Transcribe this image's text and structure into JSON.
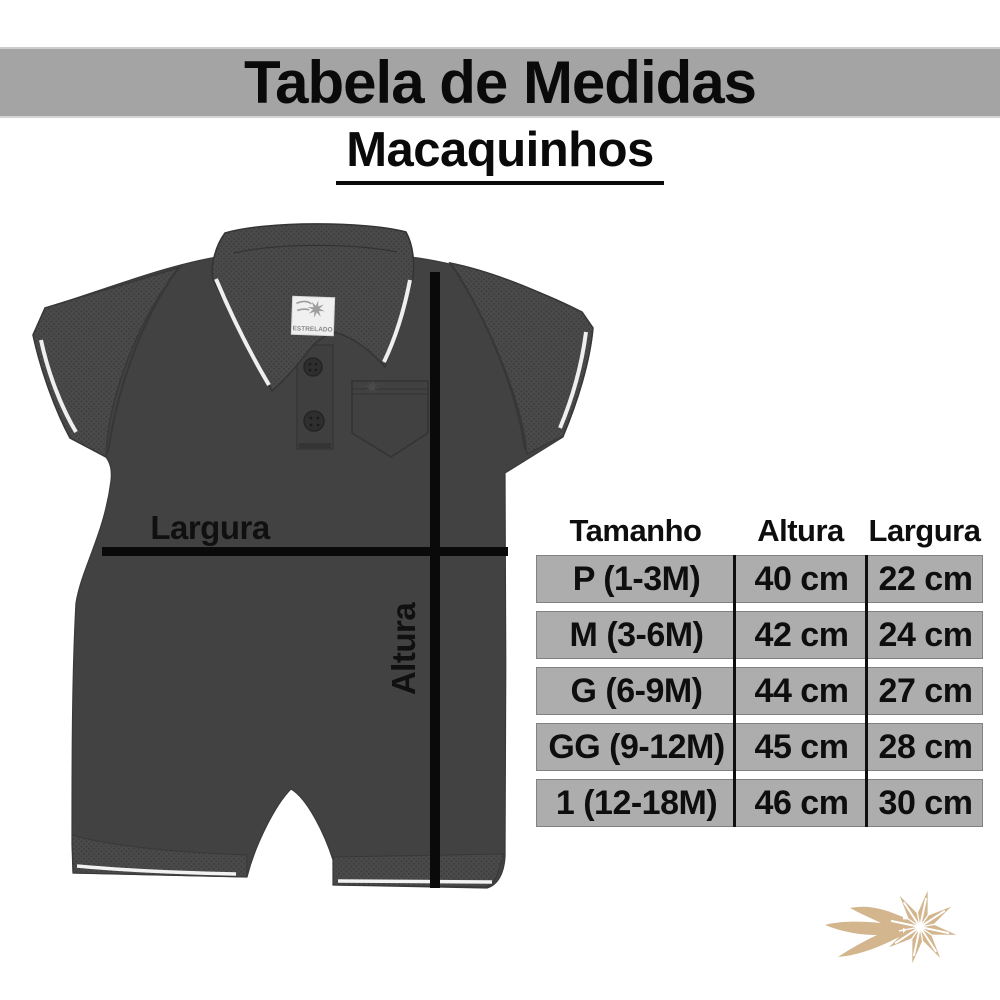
{
  "header": {
    "title": "Tabela de Medidas",
    "subtitle": "Macaquinhos",
    "band_color": "#a4a4a4"
  },
  "diagram": {
    "width_label": "Largura",
    "height_label": "Altura",
    "tag_brand": "ESTRELADO",
    "garment_color": "#424242",
    "line_color": "#0a0a0a"
  },
  "size_table": {
    "headers": [
      "Tamanho",
      "Altura",
      "Largura"
    ],
    "rows": [
      [
        "P (1-3M)",
        "40 cm",
        "22 cm"
      ],
      [
        "M (3-6M)",
        "42 cm",
        "24 cm"
      ],
      [
        "G (6-9M)",
        "44 cm",
        "27 cm"
      ],
      [
        "GG (9-12M)",
        "45 cm",
        "28 cm"
      ],
      [
        "1 (12-18M)",
        "46 cm",
        "30 cm"
      ]
    ],
    "row_color": "#adadad"
  },
  "logo": {
    "icon": "shooting-star-icon",
    "color": "#d3b58e"
  }
}
